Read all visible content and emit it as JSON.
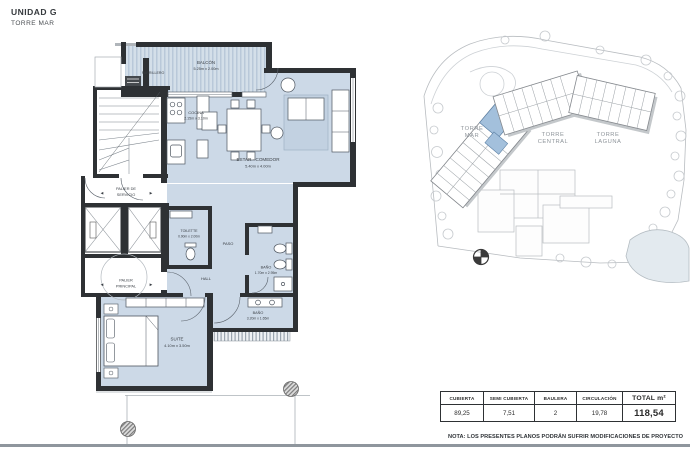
{
  "header": {
    "unit": "UNIDAD G",
    "tower": "TORRE MAR"
  },
  "floor_plan": {
    "labels": [
      {
        "id": "parrillero",
        "lines": [
          "PARRILLERO",
          ""
        ]
      },
      {
        "id": "balcon",
        "lines": [
          "BALCÓN",
          "5.25m x 2.00m"
        ]
      },
      {
        "id": "cocina",
        "lines": [
          "COCINA",
          "2.15m x 3.10m"
        ]
      },
      {
        "id": "estar-comedor",
        "lines": [
          "ESTAR - COMEDOR",
          "5.40m x 4.00m"
        ]
      },
      {
        "id": "palier-servicio",
        "lines": [
          "PALIER DE",
          "SERVICIO"
        ]
      },
      {
        "id": "toilette",
        "lines": [
          "TOILETTE",
          "0.90m x 2.00m"
        ]
      },
      {
        "id": "paso",
        "lines": [
          "PASO",
          ""
        ]
      },
      {
        "id": "hall",
        "lines": [
          "HALL",
          ""
        ]
      },
      {
        "id": "bano-suite",
        "lines": [
          "BAÑO",
          "1.70m x 2.95m"
        ]
      },
      {
        "id": "palier-principal",
        "lines": [
          "PALIER",
          "PRINCIPAL"
        ]
      },
      {
        "id": "bano",
        "lines": [
          "BAÑO",
          "3.20m x 1.65m"
        ]
      },
      {
        "id": "suite",
        "lines": [
          "SUITE",
          "4.10m x 3.50m"
        ]
      }
    ]
  },
  "site_plan": {
    "towers": [
      {
        "id": "torre-mar",
        "lines": [
          "TORRE",
          "MAR"
        ]
      },
      {
        "id": "torre-central",
        "lines": [
          "TORRE",
          "CENTRAL"
        ]
      },
      {
        "id": "torre-laguna",
        "lines": [
          "TORRE",
          "LAGUNA"
        ]
      }
    ]
  },
  "summary_table": {
    "columns": [
      "CUBIERTA",
      "SEMI CUBIERTA",
      "BAULERA",
      "CIRCULACIÓN",
      "TOTAL m²"
    ],
    "values": [
      "89,25",
      "7,51",
      "2",
      "19,78",
      "118,54"
    ]
  },
  "note": "NOTA: LOS PRESENTES PLANOS PODRÁN SUFRIR MODIFICACIONES DE PROYECTO",
  "icons": {
    "arrow_left": "◄",
    "arrow_right": "►",
    "compass": "⊕"
  },
  "colors": {
    "room_fill": "#ccd9e7",
    "wall": "#2e3134",
    "balcony_stripe": "#b9c8d9",
    "highlight_unit": "#a3c0dc",
    "bottom_bar": "#8f969d"
  }
}
